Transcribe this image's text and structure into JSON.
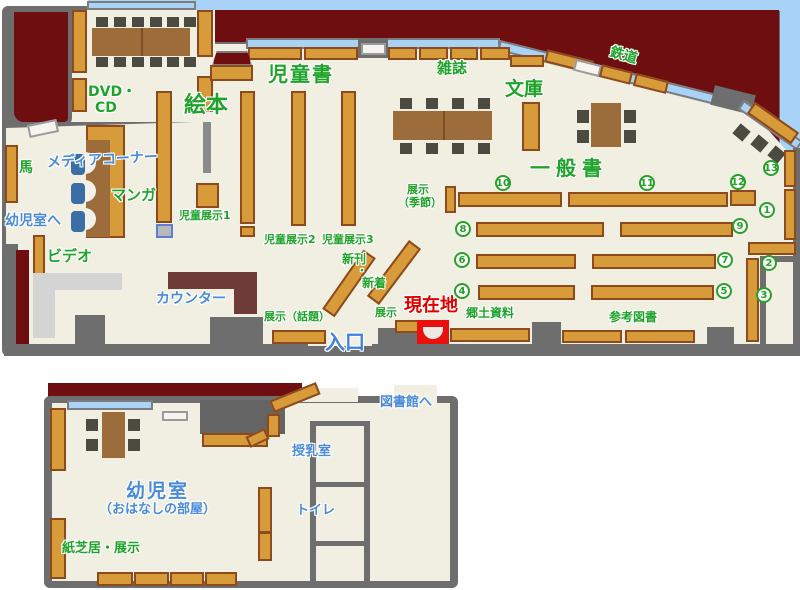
{
  "colors": {
    "wall": "#6e6e6e",
    "floor": "#f0efe1",
    "outside_red": "#6e0e10",
    "sky_window_blue": "#a9d3f6",
    "shelf_orange": "#d79b3a",
    "shelf_border": "#8d4a1c",
    "table_brown": "#9c6d3a",
    "counter_desk": "#6f3c38",
    "green_label": "#1fa32a",
    "blue_label": "#4a8bd8",
    "current_location_red": "#e8110f"
  },
  "upper": {
    "areas": {
      "jidousho": "児童書",
      "ehon": "絵本",
      "zasshi": "雑誌",
      "bunko": "文庫",
      "tetsudou": "鉄道",
      "ippansho": "一般書",
      "dvd_line1": "DVD・",
      "dvd_line2": "CD",
      "media_corner": "メディアコーナー",
      "manga": "マンガ",
      "uma": "馬",
      "to_youjishitsu": "幼児室へ",
      "video": "ビデオ",
      "counter": "カウンター",
      "jidou_tenji1": "児童展示1",
      "jidou_tenji2": "児童展示2",
      "jidou_tenji3": "児童展示3",
      "shinkan": "新刊",
      "nakaguro": "・",
      "shinchaku": "新着",
      "tenji_kisetsu_line1": "展示",
      "tenji_kisetsu_line2": "（季節）",
      "tenji_wadai": "展示（話題）",
      "tenji_small": "展示",
      "genzaichi": "現在地",
      "iriguchi": "入口",
      "kyoudo_shiryou": "郷土資料",
      "sankou_tosho": "参考図書"
    },
    "numbers": {
      "n1": "1",
      "n2": "2",
      "n3": "3",
      "n4": "4",
      "n5": "5",
      "n6": "6",
      "n7": "7",
      "n8": "8",
      "n9": "9",
      "n10": "10",
      "n11": "11",
      "n12": "12",
      "n13": "13"
    }
  },
  "lower": {
    "areas": {
      "youjishitsu": "幼児室",
      "youjishitsu_sub": "（おはなしの部屋）",
      "kamishibai_tenji": "紙芝居・展示",
      "junyuushitsu": "授乳室",
      "toire": "トイレ",
      "to_toshokan": "図書館へ"
    }
  }
}
